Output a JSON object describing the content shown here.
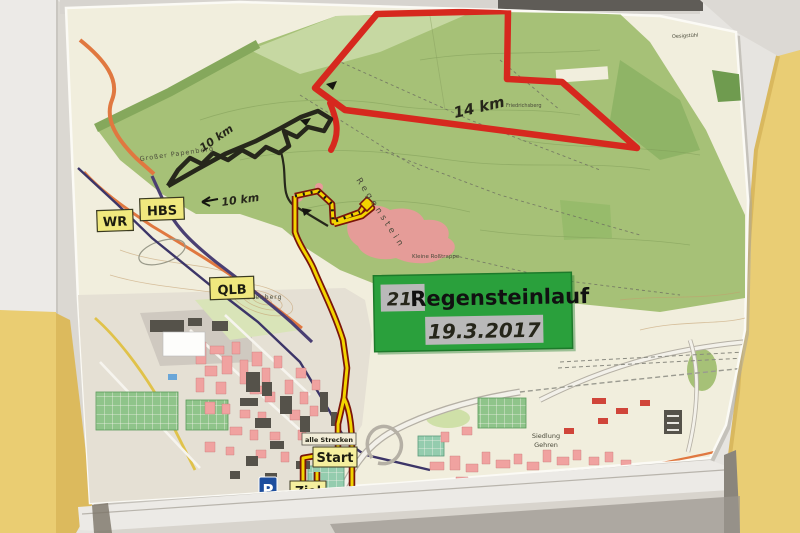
{
  "event_sign": {
    "race_number": "21.",
    "race_name": "Regensteinlauf",
    "race_date": "19.3.2017"
  },
  "road_signs": {
    "hbs": "HBS",
    "wr": "WR",
    "qlb": "QLB"
  },
  "course_markers": {
    "start": "Start",
    "finish": "Ziel",
    "all_courses": "alle Strecken",
    "parking": "P"
  },
  "distance_labels": {
    "red_course": "14 km",
    "black_course_upper": "10 km",
    "black_course_lower": "10 km"
  },
  "place_names": {
    "papenberg": "Großer Papenberg",
    "regenstein": "Regenstein",
    "platenberg": "Platenberg",
    "friedrichsberg": "Friedrichsberg",
    "rosstrappe": "Kleine Roßtrappe",
    "oesig": "Oesigstühl",
    "siedlung": "Siedlung",
    "gehren": "Gehren"
  },
  "colors": {
    "red_route": "#d6281e",
    "dark_route": "#26271b",
    "yellow_route": "#f2d400",
    "route_casing": "#7a150a",
    "sign_green": "#2aa03c",
    "wall_yellow": "#e9cd74",
    "map_cream": "#f1eedd",
    "forest_green": "#a6c177"
  }
}
